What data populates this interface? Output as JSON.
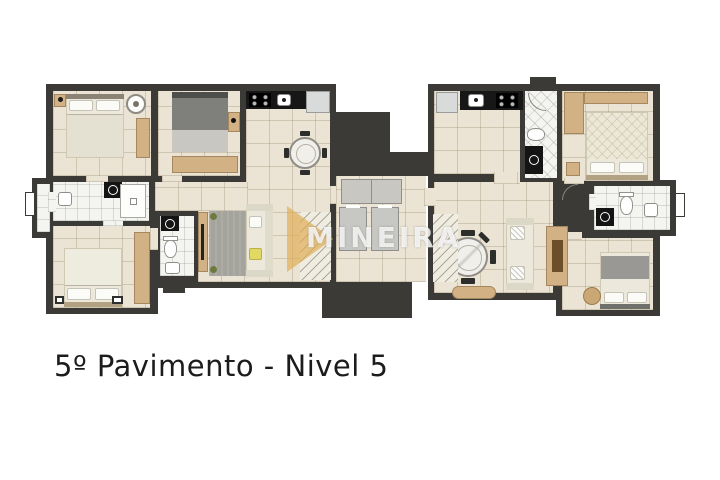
{
  "title": "5º Pavimento - Nivel 5",
  "watermark": {
    "text": "MINEIRA"
  },
  "colors": {
    "background": "#ffffff",
    "wall": "#3b3a37",
    "floor_tile": "#ebe4d4",
    "bath_tile": "#f4f4f1",
    "wood": "#d2b184",
    "counter": "#171717",
    "rug": "#a5a49c",
    "elevator": "#c7c7c3",
    "accent_pillow": "#e2d963",
    "watermark_gold": "#dfae52",
    "title_text": "#1c1c1c"
  }
}
